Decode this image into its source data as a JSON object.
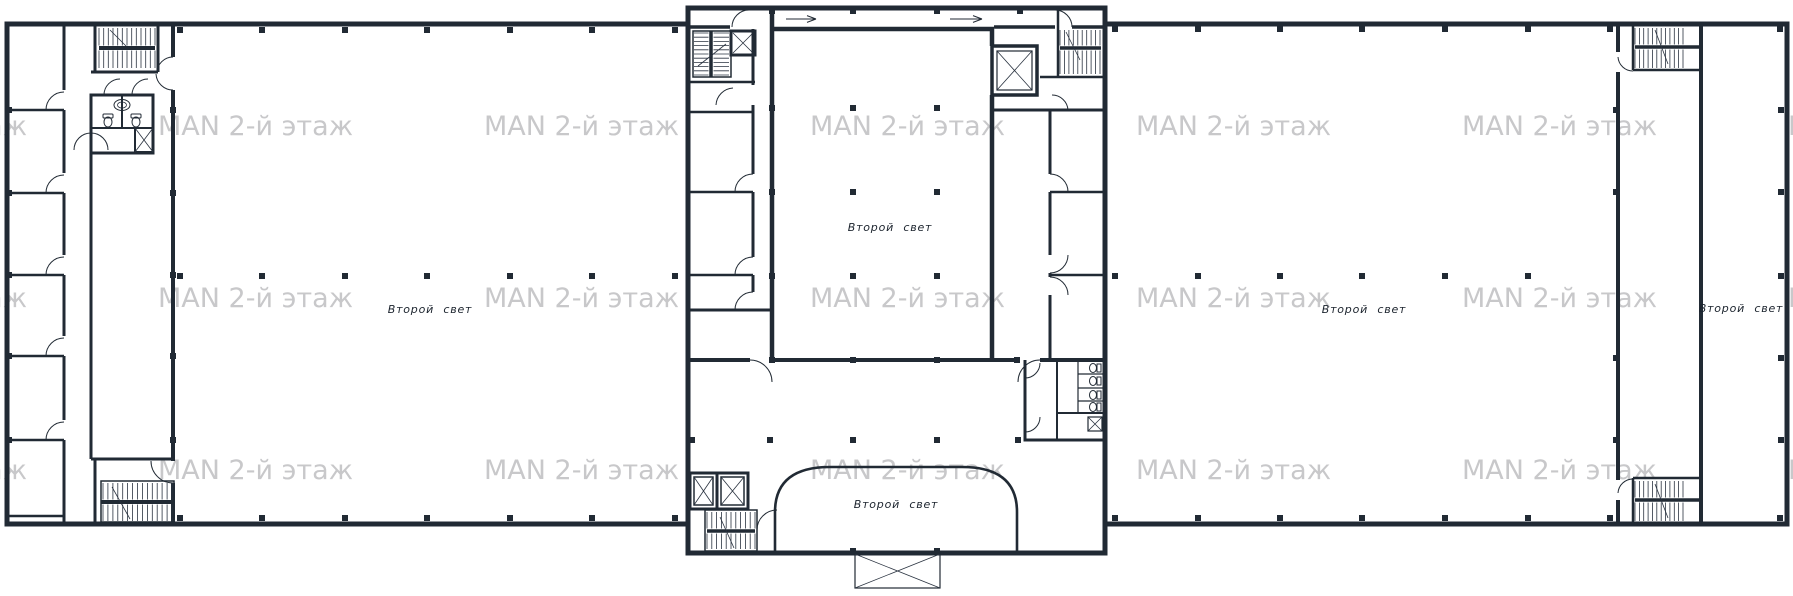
{
  "plan": {
    "watermark_text": "MAN 2-й этаж",
    "labels": {
      "left_wing": "Второй свет",
      "central_atrium": "Второй свет",
      "central_arch": "Второй свет",
      "right_wing": "Второй свет",
      "right_strip": "Второй свет"
    },
    "colors": {
      "wall": "#212a34",
      "watermark": "#c8c8ca",
      "background": "#ffffff"
    }
  }
}
